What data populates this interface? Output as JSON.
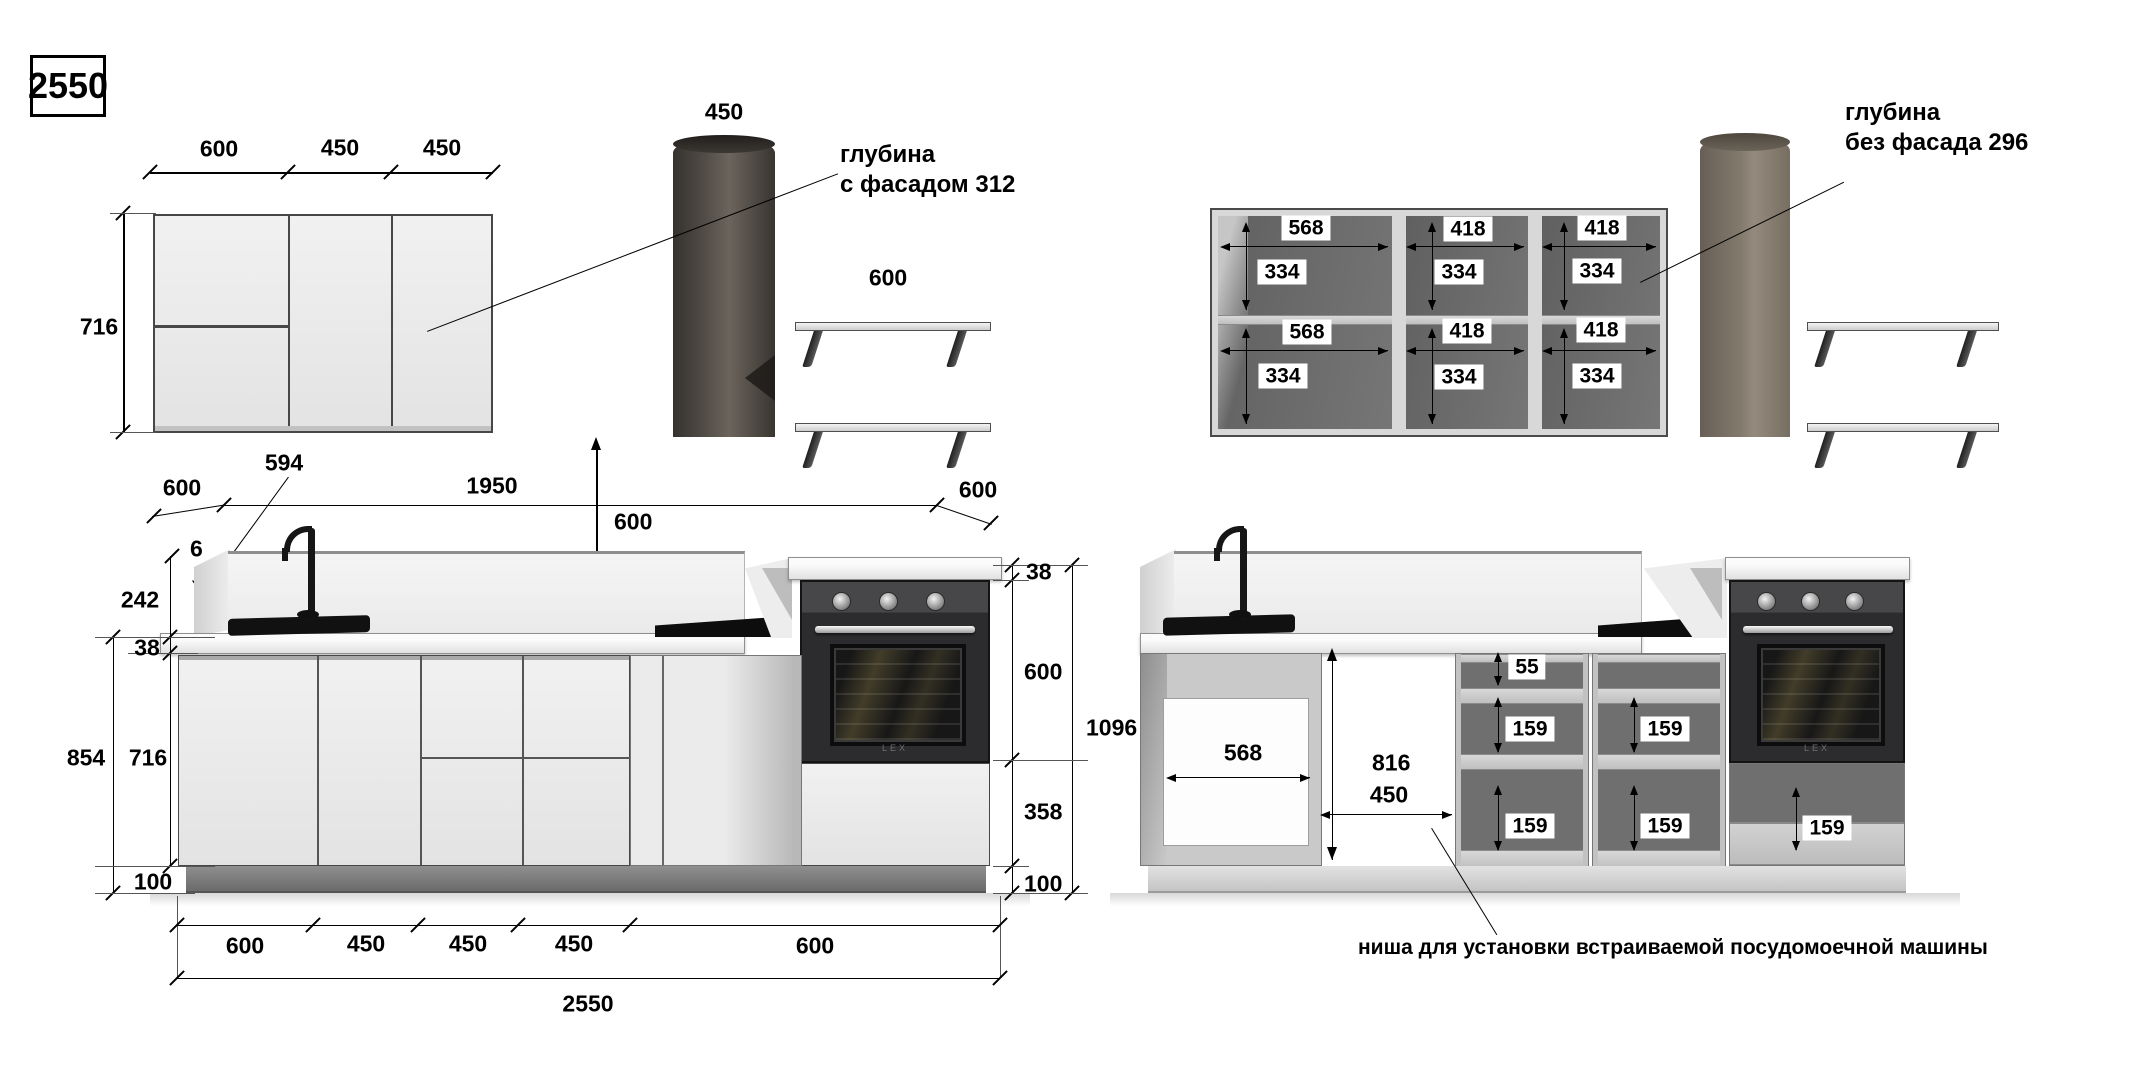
{
  "texts": {
    "title": "2550",
    "depth_front": "глубина\nс фасадом 312",
    "depth_nofront": "глубина\nбез фасада 296",
    "dw_note": "ниша для установки встраиваемой посудомоечной машины",
    "oven_brand": "LEX"
  },
  "lv": {
    "top_dims": [
      "600",
      "450",
      "450"
    ],
    "upper_h": "716",
    "hood_w": "450",
    "shelf_w": "600",
    "lead": "594",
    "depth_l": "600",
    "run": "1950",
    "depth_r": "600",
    "panel_t": "6",
    "splash_h": "242",
    "top_t": "38",
    "outer_h": "854",
    "inner_h": "716",
    "plinth": "100",
    "gap": "600",
    "top_t_r": "38",
    "oven_h": "600",
    "under_oven": "358",
    "plinth_r": "100",
    "total_h": "1096",
    "bottom_dims": [
      "600",
      "450",
      "450",
      "450",
      "600"
    ],
    "total_w": "2550"
  },
  "rv": {
    "cab_labels": [
      [
        "568",
        "334",
        "568",
        "334"
      ],
      [
        "418",
        "334",
        "418",
        "334"
      ],
      [
        "418",
        "334",
        "418",
        "334"
      ]
    ],
    "niche_w": "568",
    "niche_h": "816",
    "niche_gap": "450",
    "drawer_small": "55",
    "drawer_box": "159"
  }
}
